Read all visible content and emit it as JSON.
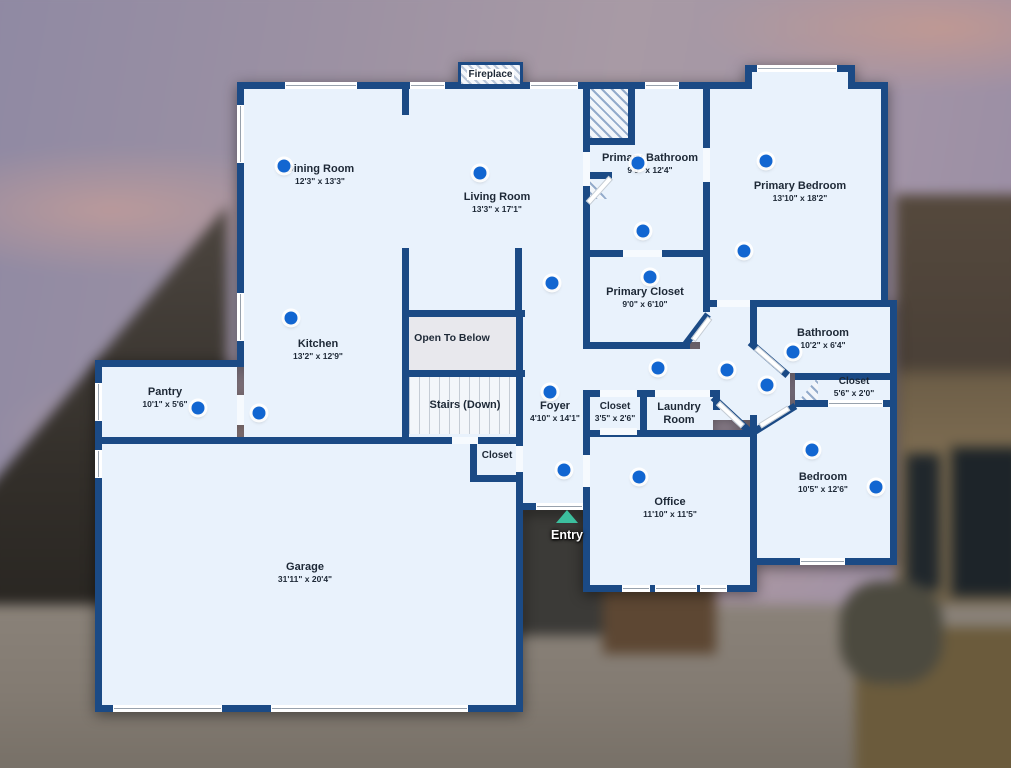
{
  "floorplan": {
    "fireplace_label": "Fireplace",
    "entry_label": "Entry",
    "labels": [
      {
        "id": "dining-room",
        "name": "Dining Room",
        "dims": "12'3\" x 13'3\"",
        "x": 320,
        "y": 163
      },
      {
        "id": "living-room",
        "name": "Living Room",
        "dims": "13'3\" x 17'1\"",
        "x": 497,
        "y": 191
      },
      {
        "id": "kitchen",
        "name": "Kitchen",
        "dims": "13'2\" x 12'9\"",
        "x": 318,
        "y": 338
      },
      {
        "id": "pantry",
        "name": "Pantry",
        "dims": "10'1\" x 5'6\"",
        "x": 165,
        "y": 386
      },
      {
        "id": "open-to-below",
        "name": "Open To Below",
        "dims": "",
        "x": 452,
        "y": 332,
        "size": 10.5
      },
      {
        "id": "stairs-down",
        "name": "Stairs (Down)",
        "dims": "",
        "x": 465,
        "y": 399
      },
      {
        "id": "closet-stairs",
        "name": "Closet",
        "dims": "",
        "x": 497,
        "y": 450,
        "size": 10
      },
      {
        "id": "foyer",
        "name": "Foyer",
        "dims": "4'10\" x 14'1\"",
        "x": 555,
        "y": 400
      },
      {
        "id": "primary-bathroom",
        "name": "Primary Bathroom",
        "dims": "9'0\" x 12'4\"",
        "x": 650,
        "y": 152
      },
      {
        "id": "primary-bedroom",
        "name": "Primary Bedroom",
        "dims": "13'10\" x 18'2\"",
        "x": 800,
        "y": 180
      },
      {
        "id": "primary-closet",
        "name": "Primary Closet",
        "dims": "9'0\" x 6'10\"",
        "x": 645,
        "y": 286
      },
      {
        "id": "bathroom",
        "name": "Bathroom",
        "dims": "10'2\" x 6'4\"",
        "x": 823,
        "y": 327
      },
      {
        "id": "closet-hall",
        "name": "Closet",
        "dims": "5'6\" x 2'0\"",
        "x": 854,
        "y": 376,
        "size": 10
      },
      {
        "id": "closet-foyer",
        "name": "Closet",
        "dims": "3'5\" x 2'6\"",
        "x": 615,
        "y": 401,
        "size": 10
      },
      {
        "id": "laundry-room",
        "name": "Laundry Room",
        "dims": "",
        "x": 679,
        "y": 401,
        "w": 76
      },
      {
        "id": "office",
        "name": "Office",
        "dims": "11'10\" x 11'5\"",
        "x": 670,
        "y": 496
      },
      {
        "id": "bedroom",
        "name": "Bedroom",
        "dims": "10'5\" x 12'6\"",
        "x": 823,
        "y": 471
      },
      {
        "id": "garage",
        "name": "Garage",
        "dims": "31'11\" x 20'4\"",
        "x": 305,
        "y": 561
      }
    ],
    "panorama_dots": [
      [
        284,
        166
      ],
      [
        480,
        173
      ],
      [
        552,
        283
      ],
      [
        291,
        318
      ],
      [
        198,
        408
      ],
      [
        259,
        413
      ],
      [
        638,
        163
      ],
      [
        643,
        231
      ],
      [
        766,
        161
      ],
      [
        744,
        251
      ],
      [
        650,
        277
      ],
      [
        550,
        392
      ],
      [
        564,
        470
      ],
      [
        658,
        368
      ],
      [
        727,
        370
      ],
      [
        767,
        385
      ],
      [
        793,
        352
      ],
      [
        639,
        477
      ],
      [
        812,
        450
      ],
      [
        876,
        487
      ]
    ],
    "colors": {
      "wall": "#1b4a85",
      "floor": "#e9f2fc",
      "dot": "#1266d1",
      "entry_arrow": "#3cbf9e",
      "open_to_below_fill": "#e8e8ed"
    }
  }
}
